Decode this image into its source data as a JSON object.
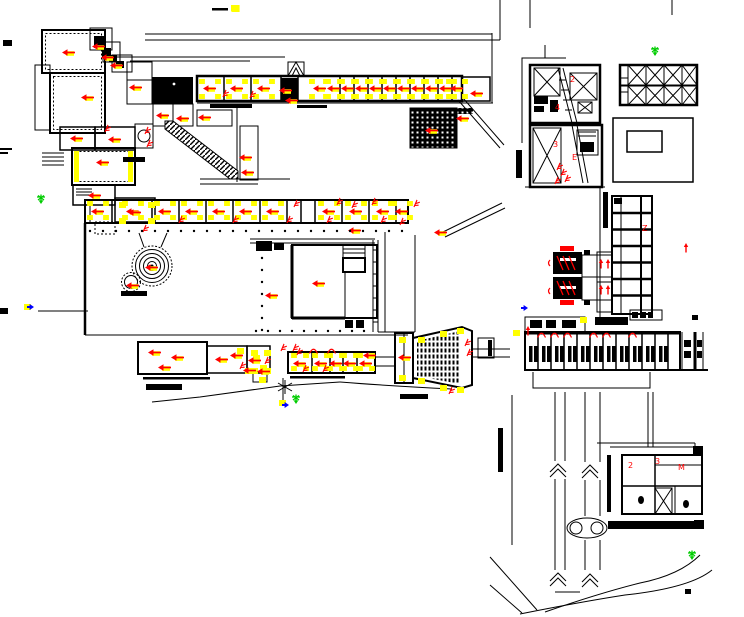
{
  "drawing": {
    "title": "architectural-site-plan",
    "background": "#ffffff",
    "colors": {
      "linework": "#000000",
      "annotation_red": "#ff0000",
      "highlight_yellow": "#ffff00",
      "stamp_green": "#00cc00",
      "mark_blue": "#0000ff"
    }
  },
  "legend": {
    "dash_x": 212,
    "dash_y": 8,
    "chip_x": 231,
    "chip_y": 5
  },
  "room_rows": [
    {
      "name": "north-classroom-row",
      "chip_dx": 8,
      "chip_y1": 81,
      "chip_y2": 96,
      "arrow_y": 88,
      "centers": [
        210,
        237,
        264,
        320,
        334,
        348,
        362,
        376,
        390,
        404,
        418,
        432,
        446,
        457
      ]
    },
    {
      "name": "mid-classroom-row",
      "chip_dx": 8,
      "chip_y1": 203,
      "chip_y2": 217,
      "arrow_y": 211,
      "centers": [
        98,
        133,
        165,
        192,
        219,
        246,
        273,
        329,
        356,
        383,
        402
      ]
    },
    {
      "name": "south-room-row",
      "chip_dx": 6,
      "chip_y1": 355,
      "chip_y2": 368,
      "arrow_y": 363,
      "centers": [
        300,
        321,
        336,
        350,
        366
      ]
    }
  ],
  "dot_rows": [
    {
      "axis": "h",
      "y": 231,
      "from": 90,
      "to": 404,
      "step": 13
    },
    {
      "axis": "h",
      "y": 331,
      "from": 256,
      "to": 374,
      "step": 12
    },
    {
      "axis": "v",
      "x": 262,
      "from": 246,
      "to": 330,
      "step": 12
    }
  ],
  "annotations": {
    "red_arrows": [
      [
        69,
        52
      ],
      [
        99,
        46
      ],
      [
        108,
        57
      ],
      [
        117,
        65
      ],
      [
        88,
        97
      ],
      [
        136,
        87
      ],
      [
        77,
        138
      ],
      [
        115,
        139
      ],
      [
        103,
        162
      ],
      [
        95,
        195
      ],
      [
        135,
        212
      ],
      [
        163,
        115
      ],
      [
        183,
        118
      ],
      [
        205,
        117
      ],
      [
        246,
        157
      ],
      [
        248,
        172
      ],
      [
        286,
        90
      ],
      [
        292,
        100
      ],
      [
        477,
        93
      ],
      [
        463,
        118
      ],
      [
        152,
        267
      ],
      [
        133,
        285
      ],
      [
        272,
        295
      ],
      [
        319,
        283
      ],
      [
        355,
        230
      ],
      [
        441,
        232
      ],
      [
        432,
        130
      ],
      [
        155,
        352
      ],
      [
        178,
        357
      ],
      [
        165,
        367
      ],
      [
        222,
        359
      ],
      [
        237,
        355
      ],
      [
        255,
        360
      ],
      [
        250,
        370
      ],
      [
        264,
        371
      ],
      [
        405,
        357
      ],
      [
        370,
        355
      ]
    ],
    "red_marks": [
      [
        182,
        219
      ],
      [
        236,
        219
      ],
      [
        290,
        219
      ],
      [
        330,
        219
      ],
      [
        384,
        219
      ],
      [
        226,
        93
      ],
      [
        253,
        94
      ],
      [
        148,
        130
      ],
      [
        150,
        143
      ],
      [
        108,
        128
      ],
      [
        146,
        228
      ],
      [
        300,
        351
      ],
      [
        306,
        368
      ],
      [
        326,
        368
      ],
      [
        284,
        347
      ],
      [
        296,
        347
      ],
      [
        243,
        365
      ],
      [
        268,
        360
      ],
      [
        468,
        342
      ],
      [
        470,
        352
      ],
      [
        452,
        390
      ],
      [
        560,
        166
      ],
      [
        564,
        172
      ],
      [
        568,
        178
      ],
      [
        558,
        180
      ],
      [
        340,
        201
      ],
      [
        375,
        201
      ],
      [
        403,
        221
      ],
      [
        297,
        203
      ],
      [
        355,
        204
      ],
      [
        417,
        203
      ]
    ],
    "door_arcs": [
      [
        541,
        336
      ],
      [
        554,
        336
      ],
      [
        567,
        336
      ],
      [
        593,
        336
      ],
      [
        606,
        336
      ],
      [
        632,
        336
      ],
      [
        313,
        352
      ],
      [
        331,
        352
      ]
    ],
    "red_vert_arrows": [
      [
        601,
        264
      ],
      [
        608,
        264
      ],
      [
        601,
        290
      ],
      [
        608,
        290
      ],
      [
        686,
        248
      ],
      [
        528,
        331
      ]
    ],
    "yellow_chips": [
      [
        231,
        5
      ],
      [
        279,
        400
      ],
      [
        24,
        304
      ],
      [
        513,
        330
      ],
      [
        580,
        317
      ],
      [
        119,
        202
      ],
      [
        148,
        202
      ],
      [
        119,
        218
      ],
      [
        148,
        218
      ],
      [
        251,
        350
      ],
      [
        264,
        350
      ],
      [
        251,
        368
      ],
      [
        264,
        368
      ],
      [
        259,
        377
      ],
      [
        399,
        337
      ],
      [
        399,
        375
      ],
      [
        418,
        337
      ],
      [
        440,
        331
      ],
      [
        457,
        328
      ],
      [
        418,
        378
      ],
      [
        440,
        385
      ],
      [
        457,
        387
      ],
      [
        237,
        348
      ],
      [
        245,
        368
      ],
      [
        253,
        355
      ],
      [
        260,
        365
      ]
    ],
    "green_stamps": [
      [
        41,
        199
      ],
      [
        655,
        51
      ],
      [
        296,
        399
      ],
      [
        692,
        555
      ]
    ],
    "blue_marks": [
      [
        30,
        307
      ],
      [
        285,
        405
      ],
      [
        524,
        308
      ]
    ],
    "labels": [
      {
        "x": 570,
        "y": 82,
        "t": "2"
      },
      {
        "x": 555,
        "y": 110,
        "t": "4"
      },
      {
        "x": 553,
        "y": 147,
        "t": "3"
      },
      {
        "x": 572,
        "y": 160,
        "t": "E"
      },
      {
        "x": 642,
        "y": 231,
        "t": "Z"
      },
      {
        "x": 628,
        "y": 468,
        "t": "2"
      },
      {
        "x": 655,
        "y": 464,
        "t": "3"
      },
      {
        "x": 678,
        "y": 470,
        "t": "M"
      }
    ]
  }
}
